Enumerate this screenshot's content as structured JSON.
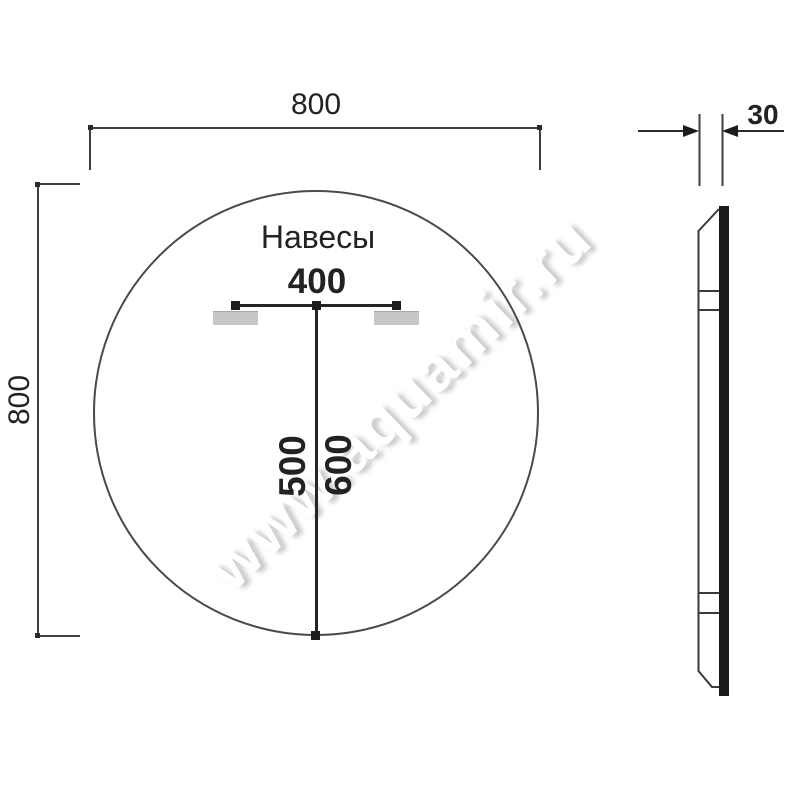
{
  "front_view": {
    "width_label": "800",
    "height_label": "800",
    "mounts_label": "Навесы",
    "mount_spacing_label": "400",
    "mount_height_label_1": "500",
    "mount_height_label_2": "600"
  },
  "side_view": {
    "thickness_label": "30"
  },
  "watermark": {
    "text": "www.aquamir.ru"
  },
  "colors": {
    "background": "#ffffff",
    "line": "#3f3f3f",
    "text": "#222222",
    "hanger_fill": "#c7c7c7",
    "glass_bar": "#191919",
    "watermark_shadow": "#a5a5a5"
  }
}
